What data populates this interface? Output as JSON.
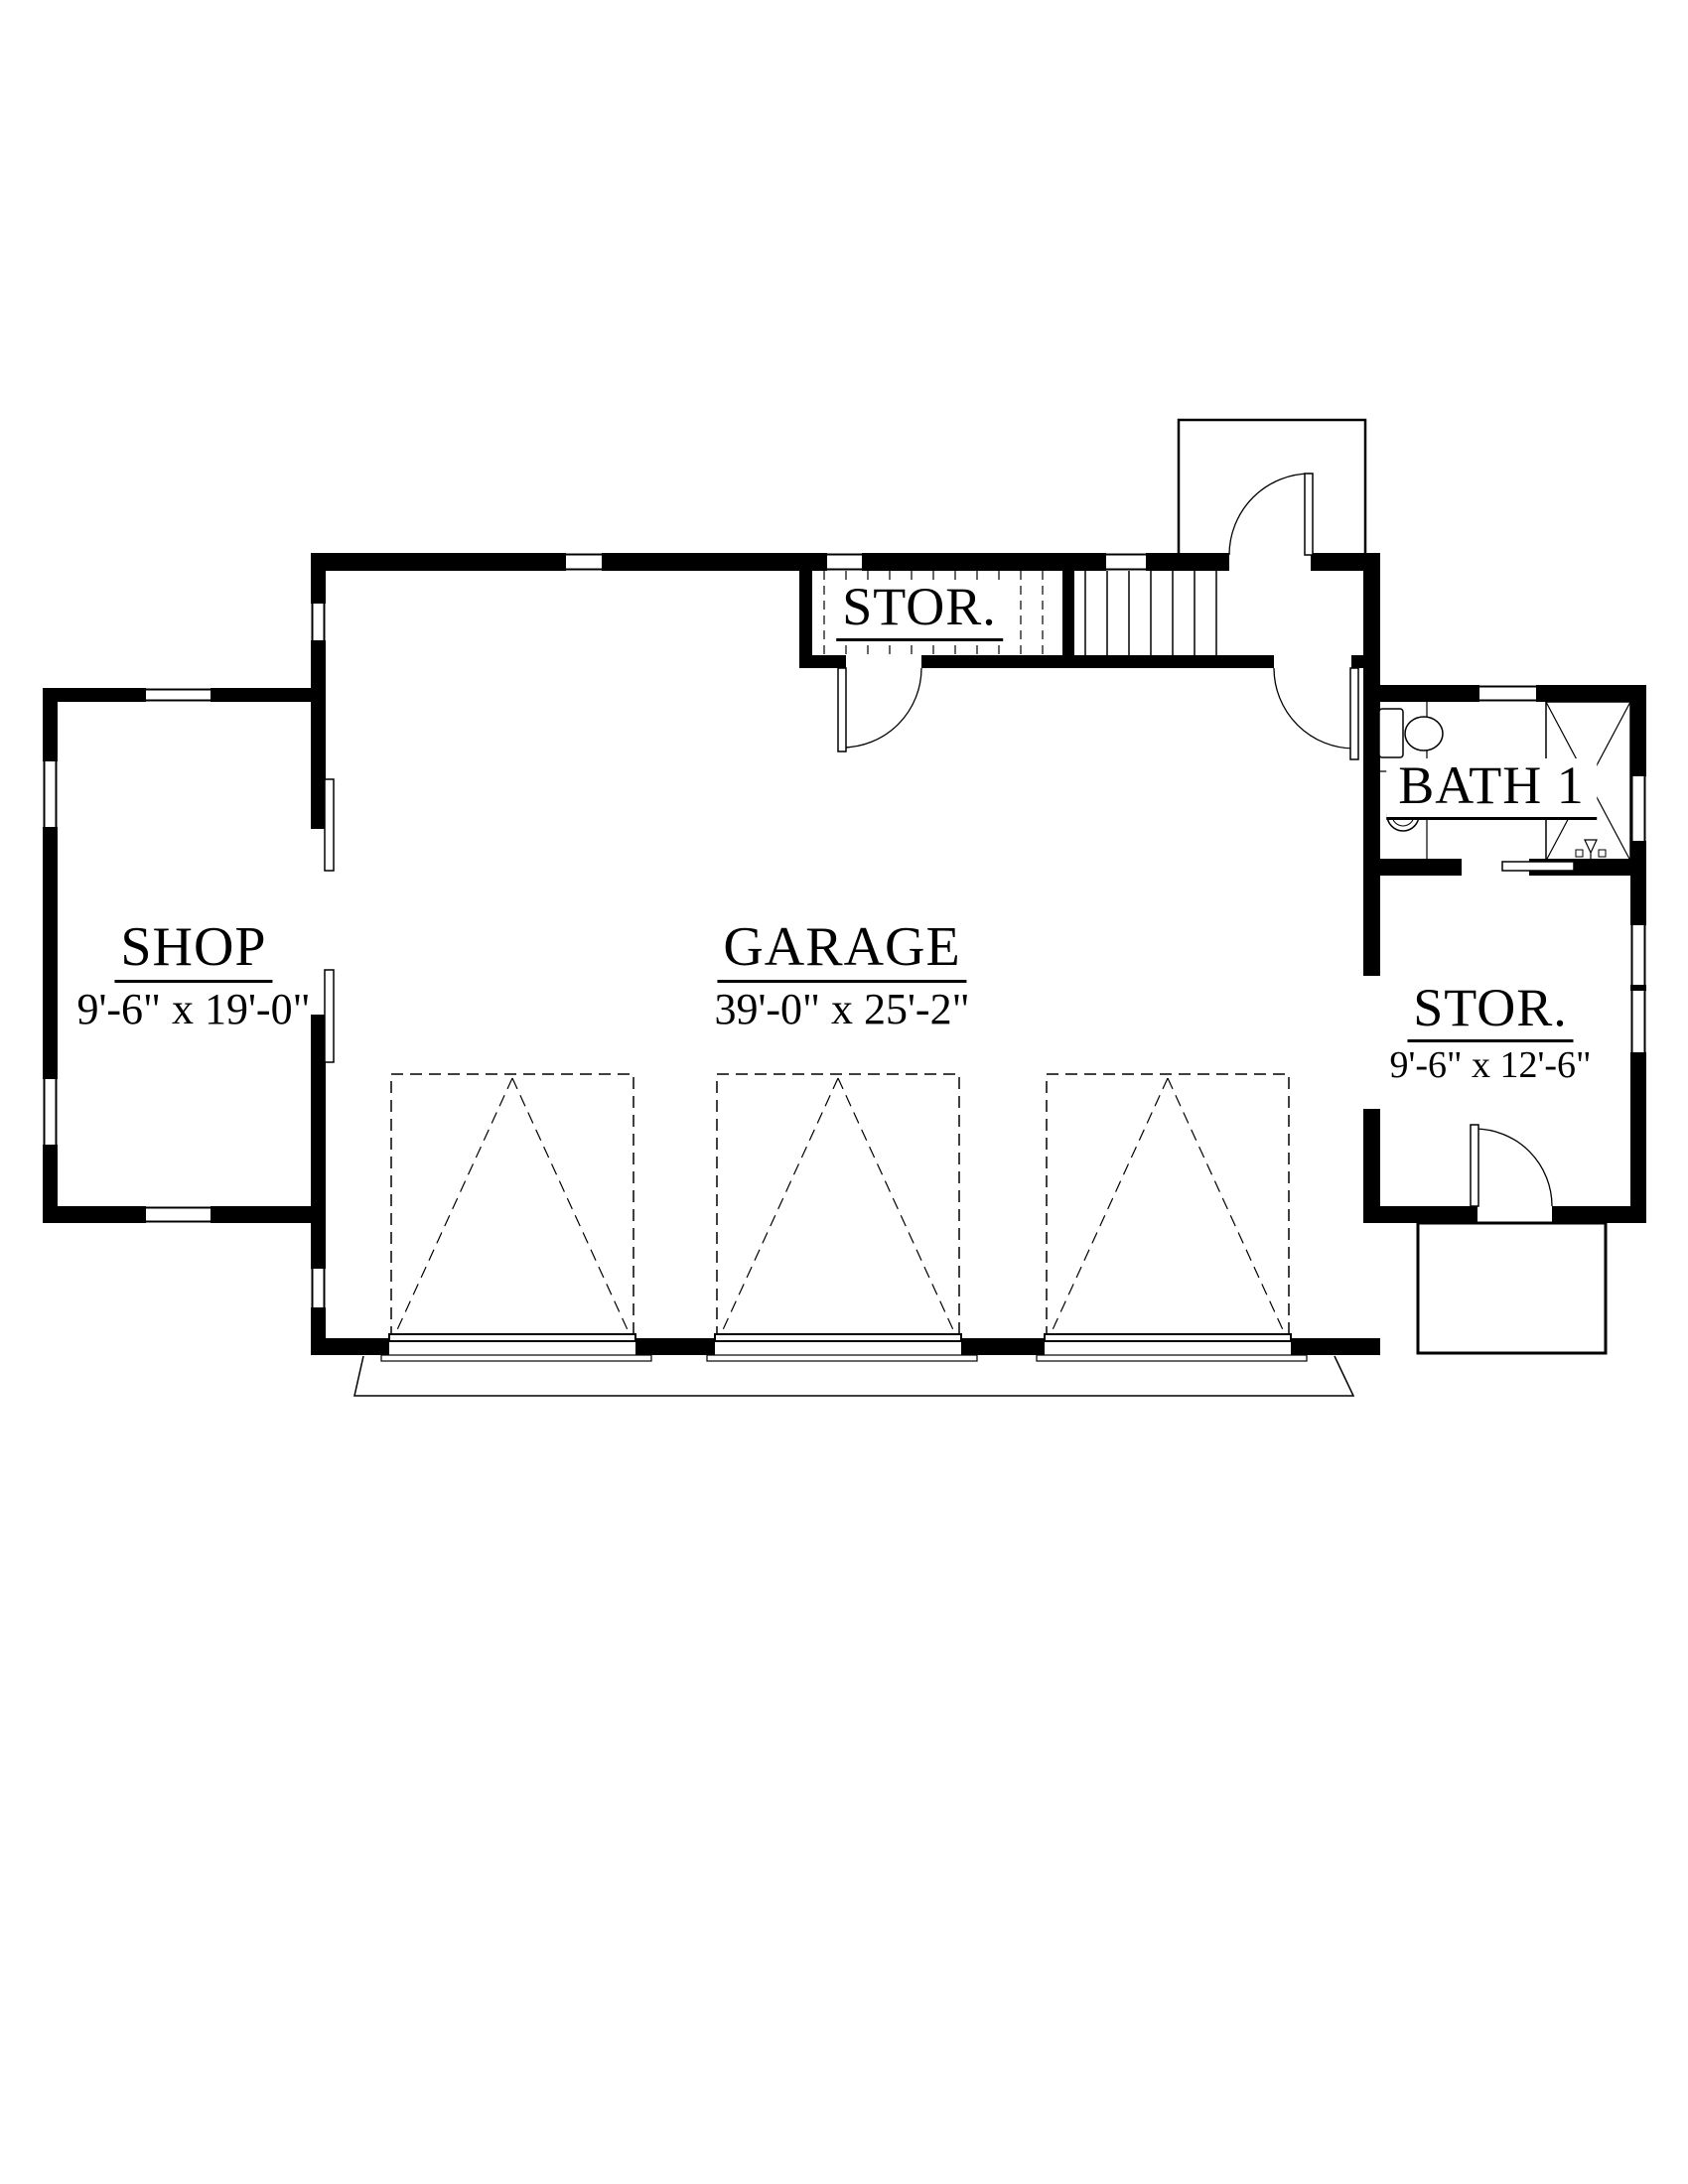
{
  "colors": {
    "ink": "#000000",
    "paper": "#ffffff"
  },
  "rooms": {
    "shop": {
      "label": "SHOP",
      "dims": "9'-6\" x 19'-0\""
    },
    "garage": {
      "label": "GARAGE",
      "dims": "39'-0\" x 25'-2\""
    },
    "storage_upper": {
      "label": "STOR."
    },
    "bath": {
      "label": "BATH 1"
    },
    "storage_right": {
      "label": "STOR.",
      "dims": "9'-6\" x 12'-6\""
    }
  }
}
